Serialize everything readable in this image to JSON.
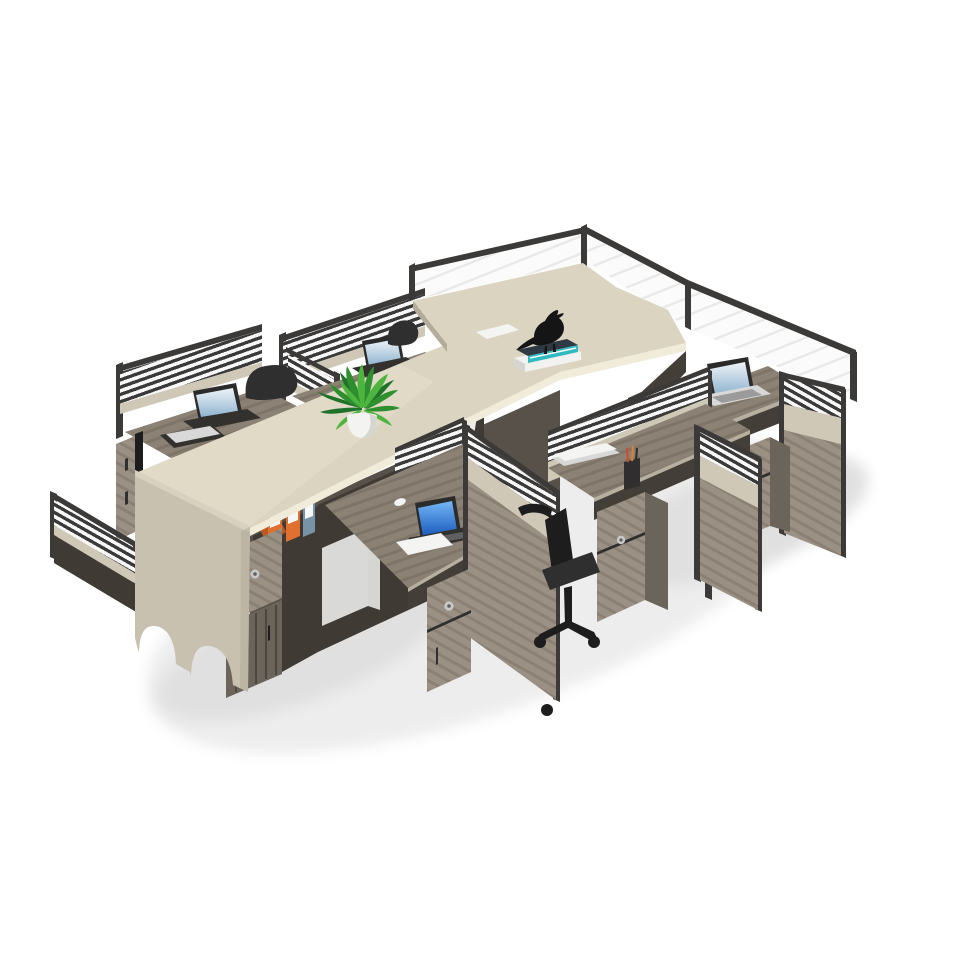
{
  "meta": {
    "description": "Product photo: six-person modular office workstation cluster in isometric view on a white background. A long beige counter with open storage cubbies crosses the cluster diagonally; grey wood-grain desks with louvered partition screens, locking pedestal cabinets, laptops, a potted green plant, orange binders, books, a black bird figurine and a black office chair.",
    "background_color": "#ffffff"
  },
  "scene": {
    "type": "product-photo",
    "subject": "6-seat office cubicle workstation system",
    "view": "isometric",
    "objects": [
      {
        "name": "workstation-desk",
        "count": 6,
        "material": "grey wood-grain laminate"
      },
      {
        "name": "partition-screen",
        "style": "black-framed louvered stripes with beige band and wood lower panel",
        "count": 6
      },
      {
        "name": "glass-top-screen",
        "style": "clear pane with thin black frame",
        "location": "back row"
      },
      {
        "name": "center-counter",
        "color_name": "beige",
        "features": [
          "open cubbies",
          "arched end panel feet"
        ]
      },
      {
        "name": "pedestal-cabinet",
        "count": 5,
        "features": [
          "drawer with metal lock",
          "door"
        ]
      },
      {
        "name": "laptop-open",
        "count": 4
      },
      {
        "name": "laptop-closed",
        "count": 2
      },
      {
        "name": "potted-plant",
        "count": 1
      },
      {
        "name": "ring-binder",
        "count": 4,
        "colors": [
          "orange",
          "orange",
          "orange",
          "blue-grey"
        ]
      },
      {
        "name": "books",
        "location": "spine cubby"
      },
      {
        "name": "bird-figurine",
        "count": 1,
        "color_name": "black"
      },
      {
        "name": "stationery-box-stack",
        "colors": [
          "teal",
          "white",
          "black"
        ]
      },
      {
        "name": "pen-cup",
        "pens": 3
      },
      {
        "name": "computer-mouse",
        "count": 2
      },
      {
        "name": "office-chair",
        "color_name": "black",
        "count": 3
      }
    ]
  },
  "colors": {
    "bg": "#ffffff",
    "shadow1": "#ededed",
    "shadow2": "#e0e0e0",
    "counterTop": "#dbd4c1",
    "counterHi": "#e7e0cd",
    "counterEdge": "#f1ebd9",
    "counterEnd": "#c8c1b0",
    "counterEndEdge": "#d8d1bf",
    "counterSide": "#b3ac9b",
    "stripeDark": "#3a3a3a",
    "stripeLight": "#f7f7f7",
    "beigeBand": "#cfc8b6",
    "frameDark": "#3b3a38",
    "glassWhite": "#fbfbfb",
    "glassStreak": "#e9e9e9",
    "woodBase": "#8b8174",
    "woodDark": "#7e7568",
    "woodLight": "#9a9083",
    "woodPedDark": "#8a8073",
    "deskEdge": "#b7af9f",
    "underDark": "#433e37",
    "cabinetDark": "#57514a",
    "cabinetDeep": "#3f3a33",
    "plinth": "#6b645a",
    "cpuBox": "#d9d9d7",
    "padWhite": "#f4f4f2",
    "laptopFrame": "#2b2b2b",
    "laptopSilver": "#d8d8d8",
    "laptopBase": "#33312e",
    "skyHi": "#eef3f7",
    "skyLo": "#8fb4d0",
    "blueHi": "#74b6f4",
    "blueLo": "#1b5cbe",
    "plantG1": "#2e8f2e",
    "plantG2": "#4db43e",
    "plantG3": "#1e722a",
    "pot": "#f3f3f1",
    "potShade": "#d5d5d1",
    "binderOrange": "#e0702f",
    "binderOrangeDark": "#bb5a22",
    "binderBlue": "#7793a6",
    "labelWhite": "#f7f7f7",
    "bookBlue": "#274f7c",
    "bookTeal": "#2fb3ae",
    "bookWhite": "#ececec",
    "pagesCream": "#e9e3d7",
    "pagesOrange": "#d98a4a",
    "chairBlack": "#1d1d1d",
    "chairDark2": "#2f2f2f",
    "metal": "#c9c9c9",
    "metalDark": "#5f5f5f",
    "boxTeal": "#2fb9c0",
    "boxWhite": "#f2f2f0",
    "boxDark": "#2e3944",
    "birdBlack": "#151515"
  }
}
